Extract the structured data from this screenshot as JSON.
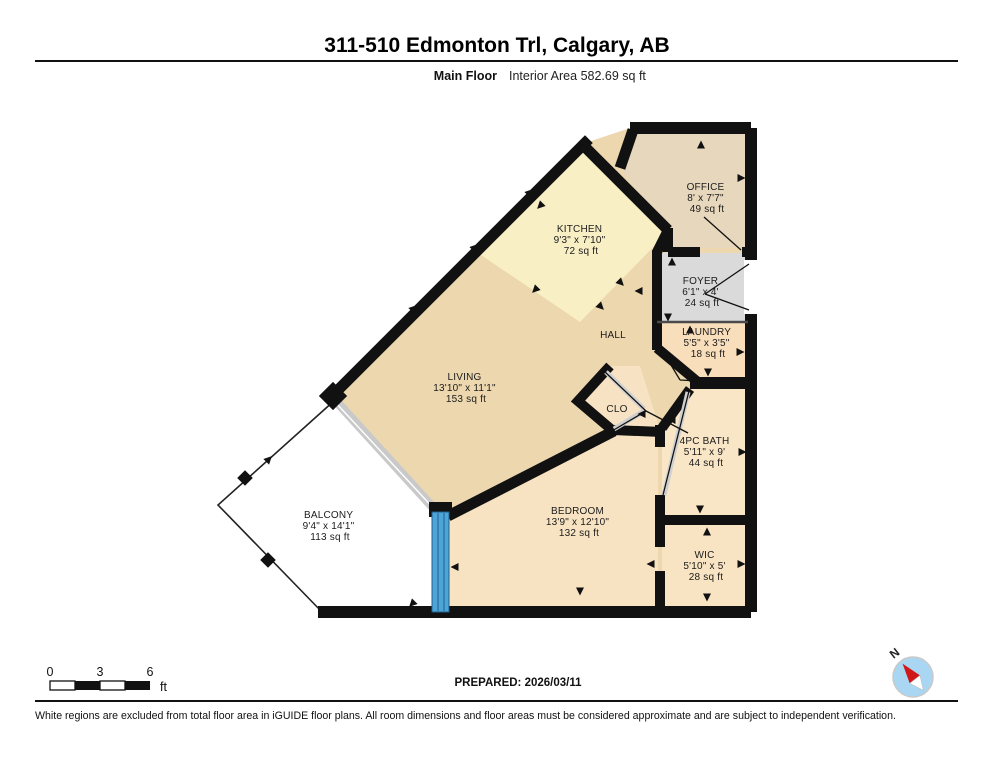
{
  "header": {
    "title": "311-510 Edmonton Trl, Calgary, AB",
    "floor_label": "Main Floor",
    "area_label": "Interior Area 582.69 sq ft"
  },
  "rooms": [
    {
      "name": "OFFICE",
      "dims": "8' x 7'7\"",
      "area": "49 sq ft"
    },
    {
      "name": "KITCHEN",
      "dims": "9'3\" x 7'10\"",
      "area": "72 sq ft"
    },
    {
      "name": "FOYER",
      "dims": "6'1\" x 4'",
      "area": "24 sq ft"
    },
    {
      "name": "LAUNDRY",
      "dims": "5'5\" x 3'5\"",
      "area": "18 sq ft"
    },
    {
      "name": "HALL"
    },
    {
      "name": "LIVING",
      "dims": "13'10\" x 11'1\"",
      "area": "153 sq ft"
    },
    {
      "name": "CLO"
    },
    {
      "name": "4PC BATH",
      "dims": "5'11\" x 9'",
      "area": "44 sq ft"
    },
    {
      "name": "BEDROOM",
      "dims": "13'9\" x 12'10\"",
      "area": "132 sq ft"
    },
    {
      "name": "BALCONY",
      "dims": "9'4\" x 14'1\"",
      "area": "113 sq ft"
    },
    {
      "name": "WIC",
      "dims": "5'10\" x 5'",
      "area": "28 sq ft"
    }
  ],
  "scale_bar": {
    "tick0": "0",
    "tick1": "3",
    "tick2": "6",
    "unit": "ft"
  },
  "compass": {
    "label": "N"
  },
  "footer": {
    "prepared": "PREPARED: 2026/03/11",
    "disclaimer": "White regions are excluded from total floor area in iGUIDE floor plans. All room dimensions and floor areas must be considered approximate and are subject to independent verification."
  },
  "colors": {
    "living": "#ecd7ae",
    "kitchen": "#f9efc5",
    "office": "#e7d7bc",
    "foyer": "#dadada",
    "laundry": "#f9debc",
    "clo": "#f7e3c4",
    "bath": "#f8e6c6",
    "bedroom": "#f7e3c2",
    "wic": "#f8e4c2",
    "balcony": "#ffffff",
    "wall": "#111111",
    "door": "#4da4d8",
    "window_band": "#c9c9c9",
    "compass_fill": "#a9d6f2",
    "compass_needle": "#d01818"
  }
}
